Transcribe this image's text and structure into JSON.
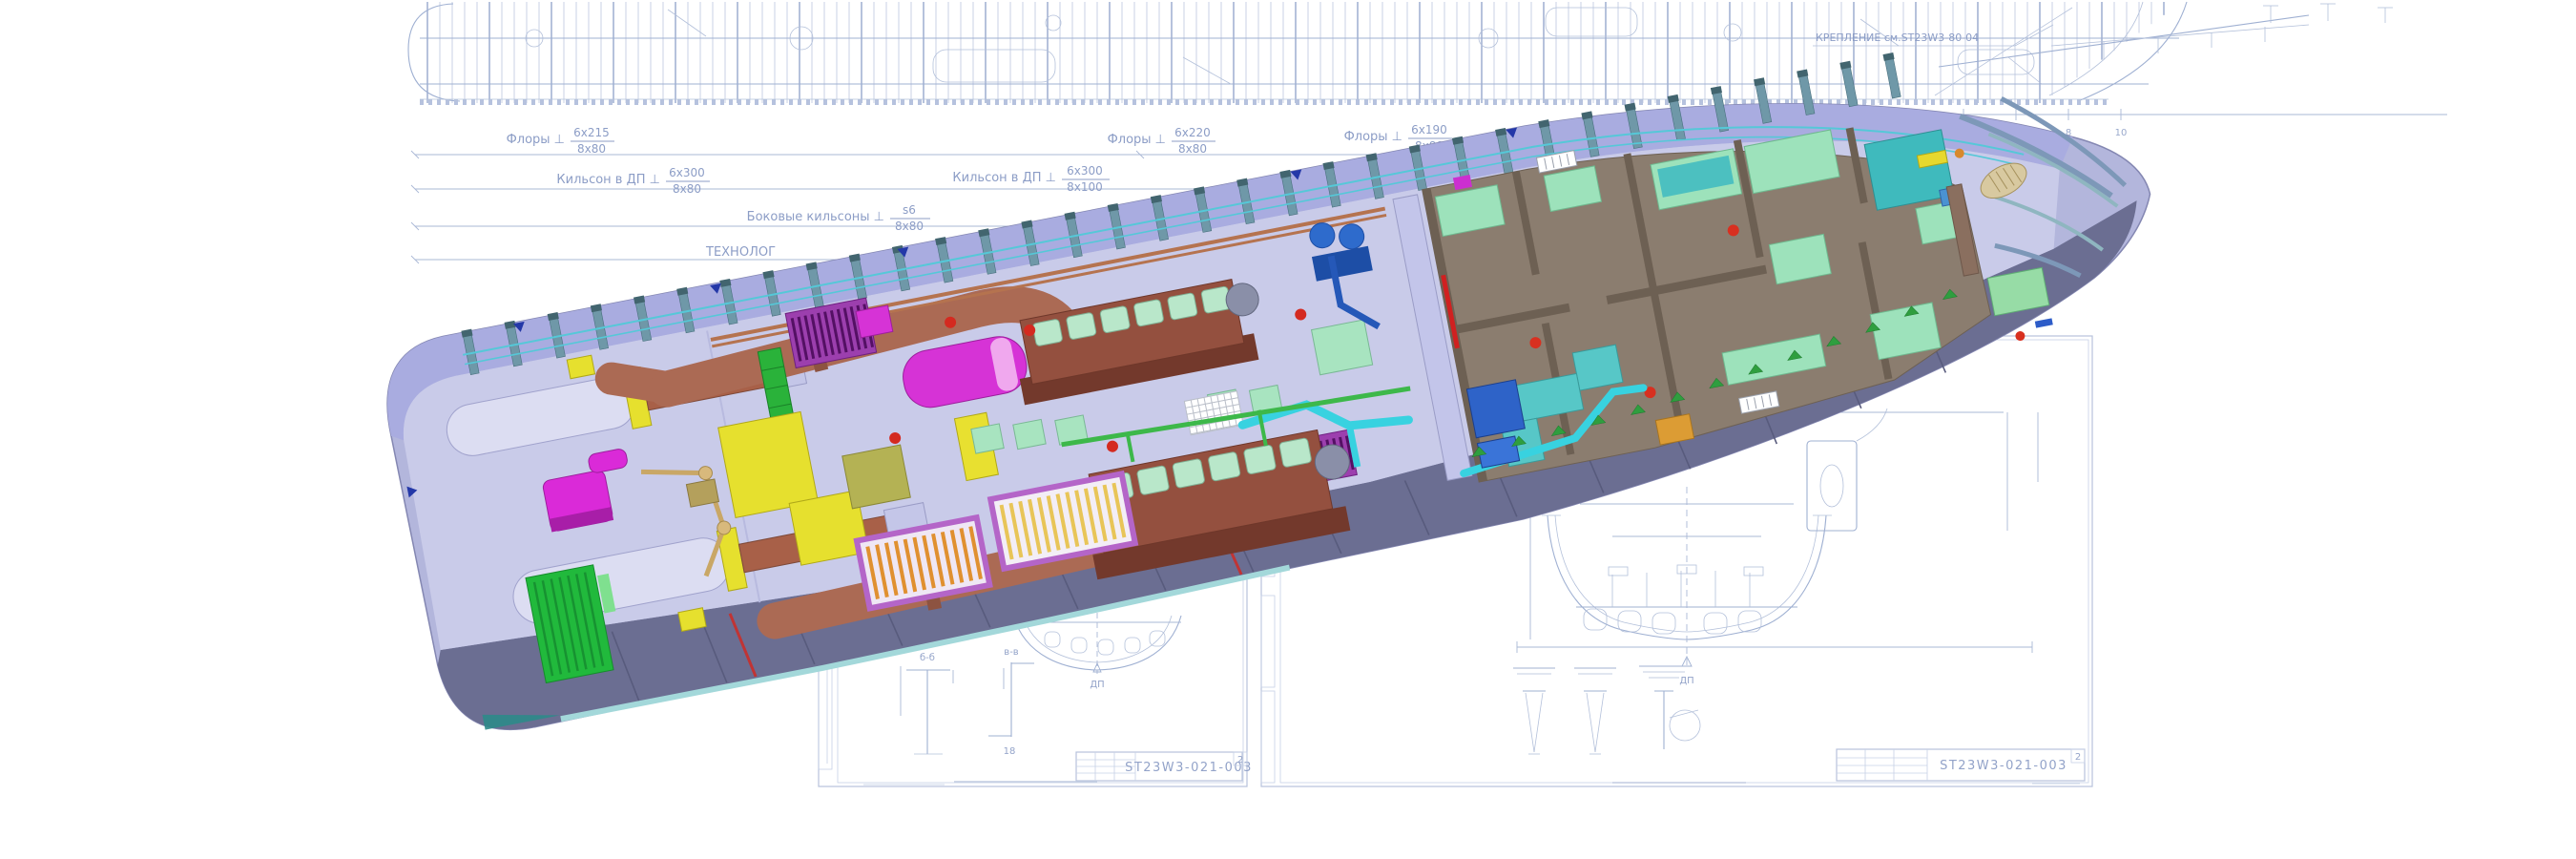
{
  "annotations": {
    "floors": [
      {
        "name": "Флоры ⊥",
        "upper": "6x215",
        "lower": "8x80"
      },
      {
        "name": "Флоры ⊥",
        "upper": "6x220",
        "lower": "8x80"
      },
      {
        "name": "Флоры ⊥",
        "upper": "6x190",
        "lower": "8x80"
      }
    ],
    "keelsons": [
      {
        "name": "Кильсон в ДП ⊥",
        "upper": "6x300",
        "lower": "8x80"
      },
      {
        "name": "Кильсон в ДП ⊥",
        "upper": "6x300",
        "lower": "8x100"
      }
    ],
    "side_keelson": {
      "name": "Боковые кильсоны ⊥",
      "upper": "s6",
      "lower": "8x80"
    },
    "partial_label": "ТЕХНОЛОГ",
    "fastening_note": "КРЕПЛЕНИЕ см.ST23W3-80-04",
    "scale_numbers": [
      "1",
      "2",
      "4",
      "6",
      "8",
      "10"
    ]
  },
  "sheets": {
    "middle": {
      "code": "ST23W3-021-003",
      "sheet": "2",
      "details": [
        "б-б",
        "в-в"
      ],
      "dim": "18",
      "centerline": "ДП"
    },
    "right": {
      "code": "ST23W3-021-003",
      "sheet": "2",
      "centerline": "ДП"
    }
  },
  "colors": {
    "blueprint_line": "#a8b5d6",
    "blueprint_text": "#8c9dc6",
    "hull_side": "#b3b6dc",
    "hull_underside": "#6b6e92",
    "deck": "#c9cbe9",
    "frame_rib": "#6f98a8",
    "stringer_cyan": "#55c8d8",
    "exhaust_pipe_brown": "#ab6a54",
    "engine_brown": "#94503f",
    "engine_head_mint": "#b9e7ca",
    "silencer_magenta": "#d633d6",
    "grille_purple": "#9c3fae",
    "tank_yellow": "#e6e02e",
    "radiator_green": "#21b93c",
    "furniture_mint": "#9de2bb",
    "furniture_teal": "#4cc0c0",
    "accommodation_taupe": "#8b7d6f",
    "pipe_cyan": "#38d2e0",
    "pump_blue": "#2e6bcc",
    "valve_red": "#d42a20",
    "keel_strip_teal": "#a3d8da"
  }
}
